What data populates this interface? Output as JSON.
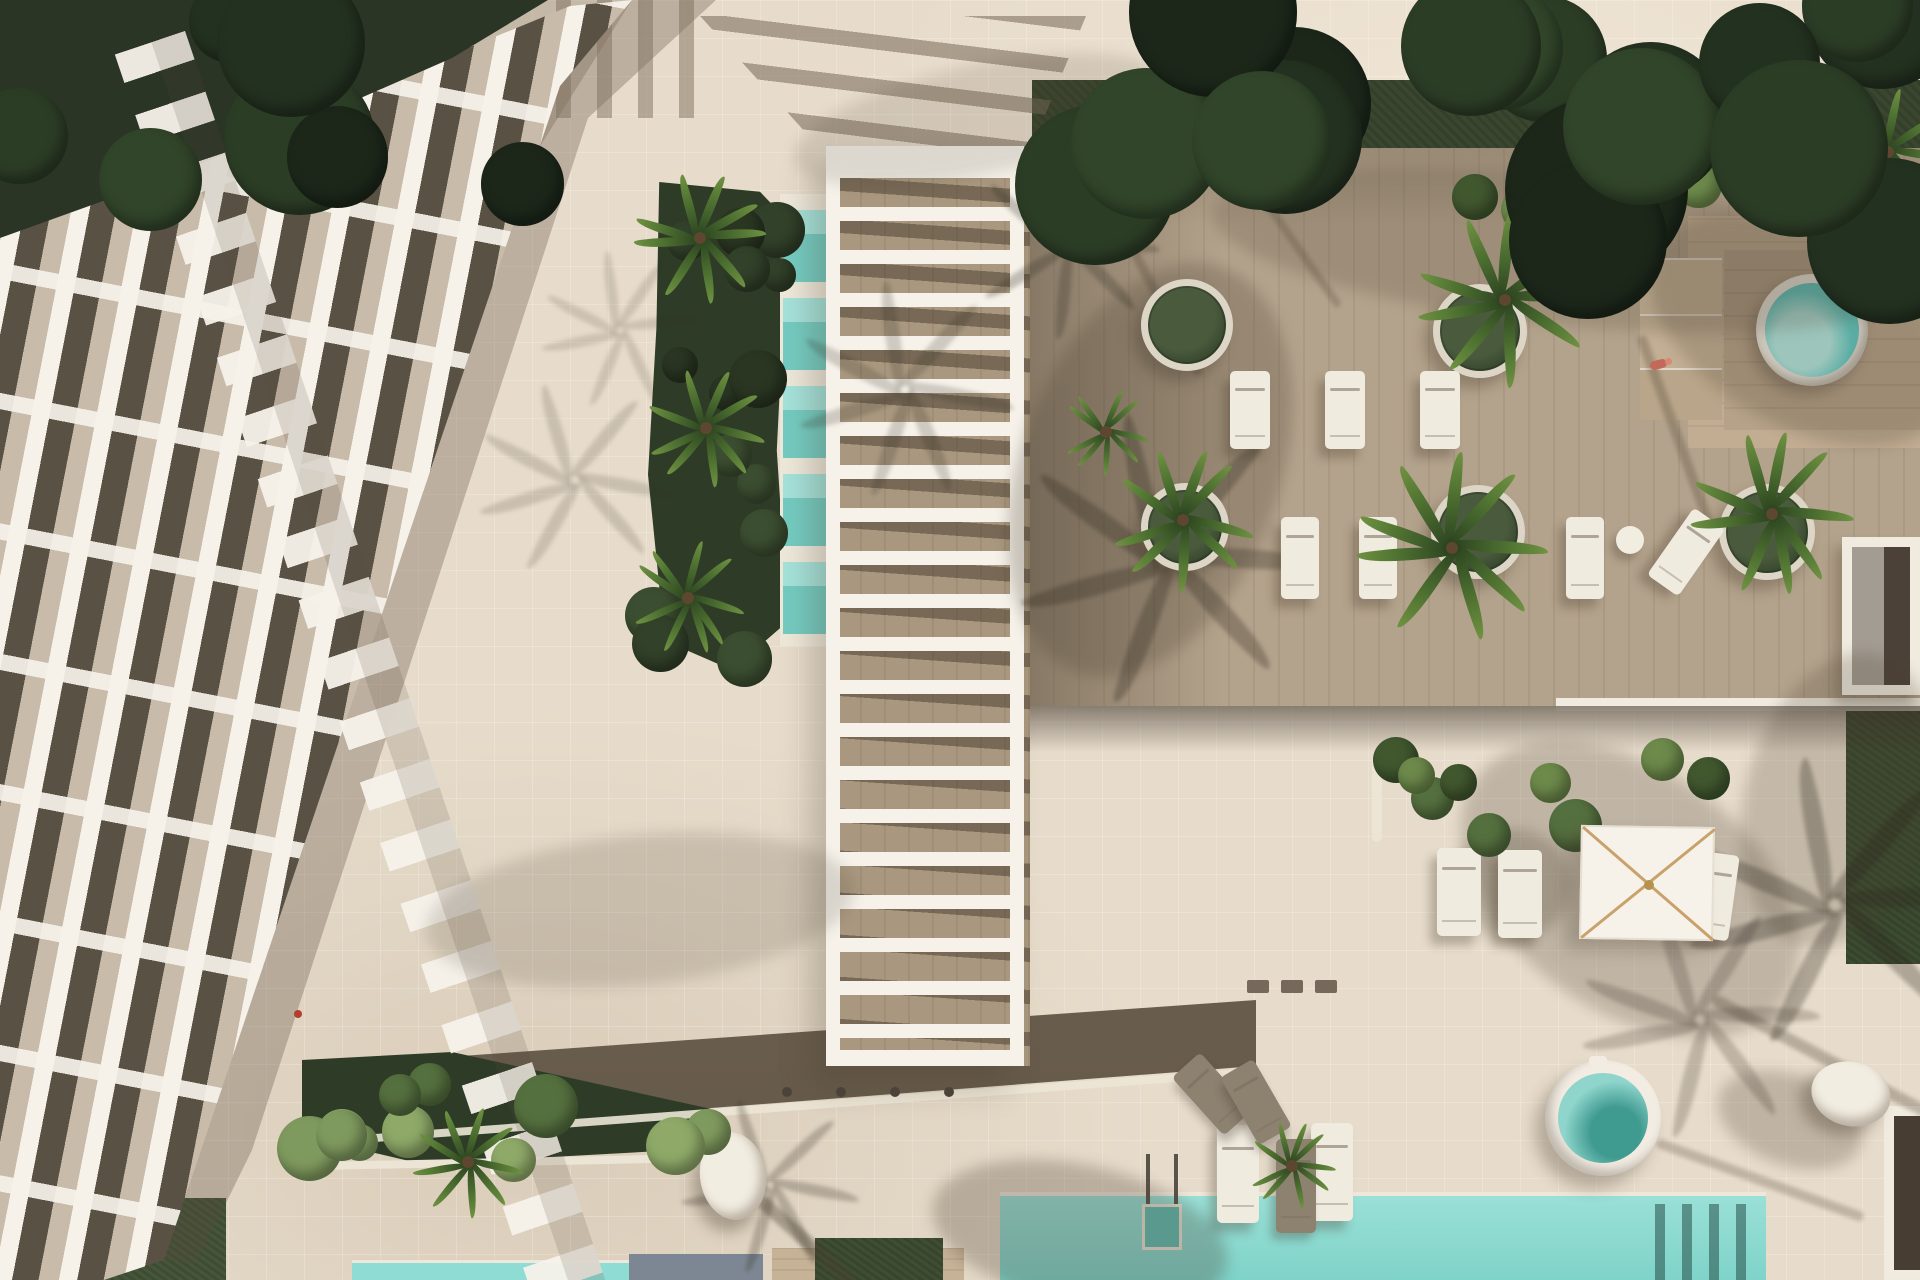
{
  "scene": {
    "title": "aerial-top-down-render-of-resort-apartment-complex-with-pools-and-deck",
    "palette": {
      "paving": "#e7dccb",
      "wood": "#b4a38c",
      "woodDark": "#6b5d4d",
      "walkway": "#796c5d",
      "lawn": "#3a462f",
      "hedge": "#2e3c27",
      "leafLight": "#7f9a5e",
      "leafMid": "#55703f",
      "leafDark": "#32412a",
      "palmDark": "#2b421f",
      "palmLight": "#6f9242",
      "treeDark": "#2b3526",
      "poolMain": "#8edcd3",
      "poolDeep": "#7fd3c9",
      "plungeLight": "#a5e2da",
      "plungeDeep": "#74cbc1",
      "spaWater": "#63cfc7",
      "white": "#f6f2ea",
      "panel": "#595144",
      "glass": "#c8bbaa",
      "slab": "#7d8793",
      "shadow": "#4a3f30",
      "person": "#c4685a",
      "rib": "#c9a26b"
    },
    "counts": {
      "round_planters": 5,
      "sun_loungers": 15,
      "round_daybeds": 2,
      "pools": 5,
      "umbrellas": 1,
      "people": 1
    },
    "items": [
      {
        "t": "shade",
        "x": 1150,
        "y": 470,
        "w": 260,
        "h": 430,
        "rot": 20,
        "o": 0.26
      },
      {
        "t": "shade",
        "x": 1560,
        "y": 250,
        "w": 700,
        "h": 150,
        "rot": 6,
        "o": 0.2
      },
      {
        "t": "shade",
        "x": 1800,
        "y": 330,
        "w": 330,
        "h": 190,
        "rot": 30,
        "o": 0.22
      },
      {
        "t": "shade",
        "x": 1630,
        "y": 890,
        "w": 380,
        "h": 240,
        "rot": 36,
        "o": 0.24
      },
      {
        "t": "shade",
        "x": 1512,
        "y": 884,
        "w": 120,
        "h": 110,
        "rot": 0,
        "o": 0.25
      },
      {
        "t": "shade",
        "x": 640,
        "y": 910,
        "w": 430,
        "h": 150,
        "rot": -6,
        "o": 0.16
      },
      {
        "t": "shade",
        "x": 1080,
        "y": 1235,
        "w": 300,
        "h": 140,
        "rot": 12,
        "o": 0.28
      },
      {
        "t": "shade",
        "x": 1840,
        "y": 800,
        "w": 190,
        "h": 300,
        "rot": 15,
        "o": 0.22
      },
      {
        "t": "shade",
        "x": 980,
        "y": 120,
        "w": 380,
        "h": 110,
        "rot": -12,
        "o": 0.14
      },
      {
        "t": "shade",
        "x": 1790,
        "y": 1120,
        "w": 150,
        "h": 90,
        "rot": 20,
        "o": 0.25
      },
      {
        "t": "streak",
        "x": 792,
        "y": 1228,
        "w": 170,
        "h": 13,
        "rot": 42,
        "o": 0.38
      },
      {
        "t": "streak",
        "x": 1160,
        "y": 300,
        "w": 170,
        "h": 9,
        "rot": 62,
        "o": 0.28
      },
      {
        "t": "streak",
        "x": 1296,
        "y": 245,
        "w": 150,
        "h": 8,
        "rot": 55,
        "o": 0.25
      },
      {
        "t": "streak",
        "x": 1675,
        "y": 430,
        "w": 200,
        "h": 10,
        "rot": 70,
        "o": 0.28
      },
      {
        "t": "streak",
        "x": 1828,
        "y": 1060,
        "w": 260,
        "h": 12,
        "rot": 28,
        "o": 0.3
      },
      {
        "t": "streak",
        "x": 1760,
        "y": 1180,
        "w": 220,
        "h": 10,
        "rot": 20,
        "o": 0.25
      },
      {
        "t": "fan",
        "x": 1165,
        "y": 560,
        "s": 150,
        "o": 0.3
      },
      {
        "t": "fan",
        "x": 1065,
        "y": 245,
        "s": 95,
        "o": 0.26
      },
      {
        "t": "fan",
        "x": 905,
        "y": 390,
        "s": 110,
        "o": 0.2
      },
      {
        "t": "fan",
        "x": 575,
        "y": 480,
        "s": 100,
        "o": 0.16
      },
      {
        "t": "fan",
        "x": 770,
        "y": 1185,
        "s": 90,
        "o": 0.25
      },
      {
        "t": "fan",
        "x": 1835,
        "y": 905,
        "s": 150,
        "o": 0.3
      },
      {
        "t": "fan",
        "x": 1700,
        "y": 1020,
        "s": 120,
        "o": 0.22
      },
      {
        "t": "fan",
        "x": 620,
        "y": 330,
        "s": 80,
        "o": 0.14
      },
      {
        "t": "planter",
        "x": 1187,
        "y": 325,
        "r": 46
      },
      {
        "t": "planter",
        "x": 1480,
        "y": 331,
        "r": 47
      },
      {
        "t": "planter",
        "x": 1185,
        "y": 527,
        "r": 44
      },
      {
        "t": "planter",
        "x": 1478,
        "y": 532,
        "r": 47
      },
      {
        "t": "planter",
        "x": 1767,
        "y": 532,
        "r": 48
      },
      {
        "t": "lounger",
        "x": 1250,
        "y": 410,
        "w": 40,
        "h": 78,
        "rot": 0
      },
      {
        "t": "lounger",
        "x": 1345,
        "y": 410,
        "w": 40,
        "h": 78,
        "rot": 0
      },
      {
        "t": "lounger",
        "x": 1440,
        "y": 410,
        "w": 40,
        "h": 78,
        "rot": 0
      },
      {
        "t": "lounger",
        "x": 1300,
        "y": 558,
        "w": 38,
        "h": 82,
        "rot": 0
      },
      {
        "t": "lounger",
        "x": 1378,
        "y": 558,
        "w": 38,
        "h": 82,
        "rot": 0
      },
      {
        "t": "lounger",
        "x": 1585,
        "y": 558,
        "w": 38,
        "h": 82,
        "rot": 0
      },
      {
        "t": "lounger",
        "x": 1686,
        "y": 552,
        "w": 38,
        "h": 82,
        "rot": 35
      },
      {
        "t": "lounger",
        "x": 1459,
        "y": 892,
        "w": 44,
        "h": 88,
        "rot": 0
      },
      {
        "t": "lounger",
        "x": 1520,
        "y": 894,
        "w": 44,
        "h": 88,
        "rot": 0
      },
      {
        "t": "lounger",
        "x": 1714,
        "y": 896,
        "w": 40,
        "h": 86,
        "rot": 8
      },
      {
        "t": "lounger",
        "x": 1238,
        "y": 1174,
        "w": 42,
        "h": 98,
        "rot": 0
      },
      {
        "t": "lounger",
        "x": 1332,
        "y": 1172,
        "w": 42,
        "h": 98,
        "rot": 0
      },
      {
        "t": "lounger",
        "x": 1212,
        "y": 1094,
        "w": 38,
        "h": 78,
        "rot": -42,
        "v": "dark"
      },
      {
        "t": "lounger",
        "x": 1256,
        "y": 1102,
        "w": 38,
        "h": 78,
        "rot": -30,
        "v": "dark"
      },
      {
        "t": "lounger",
        "x": 1296,
        "y": 1186,
        "w": 40,
        "h": 94,
        "rot": 0,
        "v": "dark"
      },
      {
        "t": "daybed",
        "x": 733,
        "y": 1176,
        "w": 66,
        "h": 88,
        "rot": -8
      },
      {
        "t": "daybed",
        "x": 1851,
        "y": 1094,
        "w": 80,
        "h": 64,
        "rot": 14
      },
      {
        "t": "tbl",
        "x": 1630,
        "y": 540,
        "r": 14
      },
      {
        "t": "dot",
        "x": 787,
        "y": 1092,
        "r": 5
      },
      {
        "t": "dot",
        "x": 841,
        "y": 1092,
        "r": 5
      },
      {
        "t": "dot",
        "x": 895,
        "y": 1092,
        "r": 5
      },
      {
        "t": "dot",
        "x": 949,
        "y": 1092,
        "r": 5
      },
      {
        "t": "mat",
        "x": 1258,
        "y": 986,
        "w": 22,
        "h": 13
      },
      {
        "t": "mat",
        "x": 1292,
        "y": 986,
        "w": 22,
        "h": 13
      },
      {
        "t": "mat",
        "x": 1326,
        "y": 986,
        "w": 22,
        "h": 13
      },
      {
        "t": "person",
        "x": 1650,
        "y": 360
      },
      {
        "t": "reddot",
        "x": 298,
        "y": 1014,
        "r": 4
      },
      {
        "t": "palm",
        "x": 1505,
        "y": 300,
        "s": 88
      },
      {
        "t": "palm",
        "x": 1183,
        "y": 520,
        "s": 72
      },
      {
        "t": "palm",
        "x": 1452,
        "y": 548,
        "s": 96
      },
      {
        "t": "palm",
        "x": 1772,
        "y": 514,
        "s": 82
      },
      {
        "t": "palm",
        "x": 1106,
        "y": 432,
        "s": 44
      },
      {
        "t": "palm",
        "x": 468,
        "y": 1162,
        "s": 56
      },
      {
        "t": "palm",
        "x": 1292,
        "y": 1166,
        "s": 44
      },
      {
        "t": "palm",
        "x": 1888,
        "y": 152,
        "s": 64
      },
      {
        "t": "palm",
        "x": 700,
        "y": 238,
        "s": 66
      },
      {
        "t": "palm",
        "x": 706,
        "y": 428,
        "s": 60
      },
      {
        "t": "palm",
        "x": 688,
        "y": 598,
        "s": 58
      },
      {
        "t": "shrubs",
        "x": 1040,
        "y": 158,
        "w": 880,
        "h": 62,
        "n": 16,
        "rmin": 14,
        "rmax": 30,
        "mode": "mix"
      },
      {
        "t": "shrubs",
        "x": 1382,
        "y": 748,
        "w": 340,
        "h": 100,
        "n": 9,
        "rmin": 18,
        "rmax": 34,
        "mode": "mix"
      },
      {
        "t": "shrubs",
        "x": 302,
        "y": 1056,
        "w": 412,
        "h": 112,
        "n": 11,
        "rmin": 18,
        "rmax": 34,
        "mode": "light"
      },
      {
        "t": "shrubs",
        "x": 652,
        "y": 190,
        "w": 132,
        "h": 470,
        "n": 14,
        "rmin": 16,
        "rmax": 30,
        "mode": "dark"
      },
      {
        "t": "trees",
        "x": 1032,
        "y": 0,
        "w": 888,
        "h": 210,
        "n": 12,
        "rmin": 40,
        "rmax": 95
      },
      {
        "t": "trees",
        "x": 0,
        "y": 0,
        "w": 548,
        "h": 215,
        "n": 7,
        "rmin": 38,
        "rmax": 80
      },
      {
        "t": "trees",
        "x": 1560,
        "y": 0,
        "w": 360,
        "h": 260,
        "n": 6,
        "rmin": 55,
        "rmax": 105
      }
    ]
  }
}
